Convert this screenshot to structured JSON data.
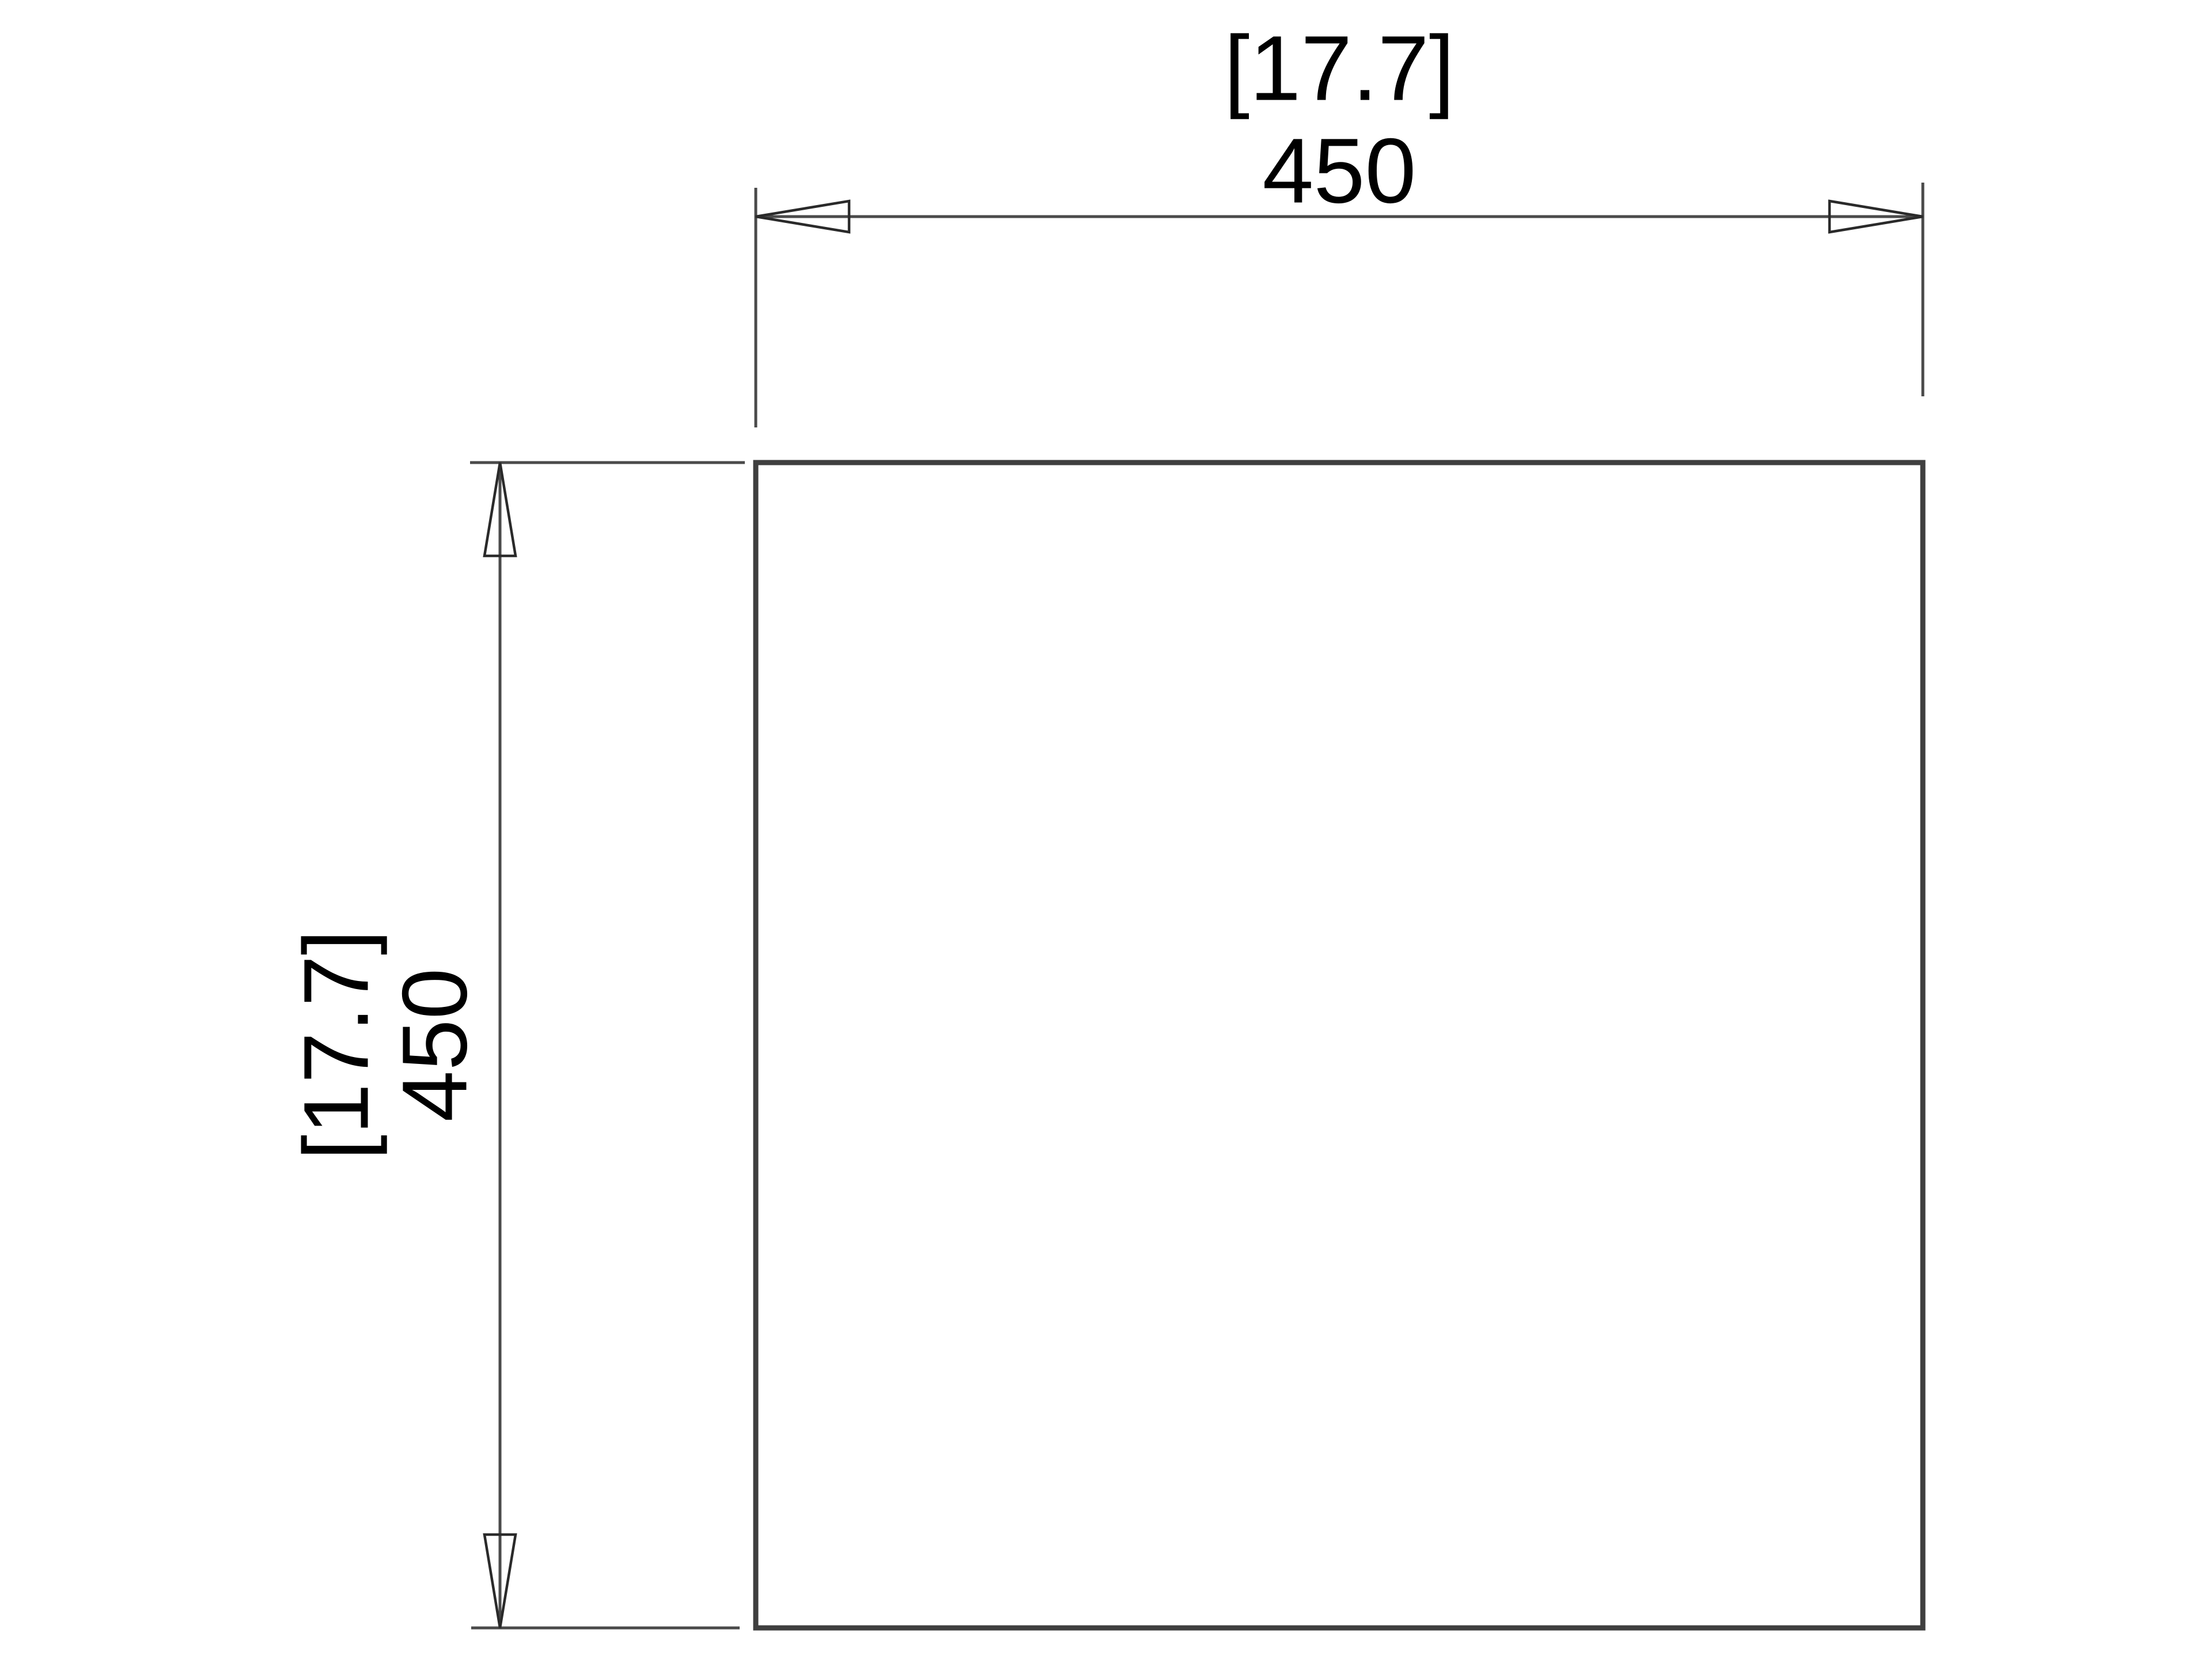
{
  "drawing": {
    "kind": "technical dimension drawing",
    "shape": "square panel outline, front view"
  },
  "dimensions": {
    "width": {
      "inches_bracketed": "[17.7]",
      "mm": "450"
    },
    "height": {
      "inches_bracketed": "[17.7]",
      "mm": "450"
    }
  },
  "theme": {
    "background": "#ffffff",
    "outline_color": "#3f3f3f",
    "dimension_line_color": "#4a4a4a",
    "arrow_color": "#2a2a2a",
    "text_color": "#000000"
  }
}
